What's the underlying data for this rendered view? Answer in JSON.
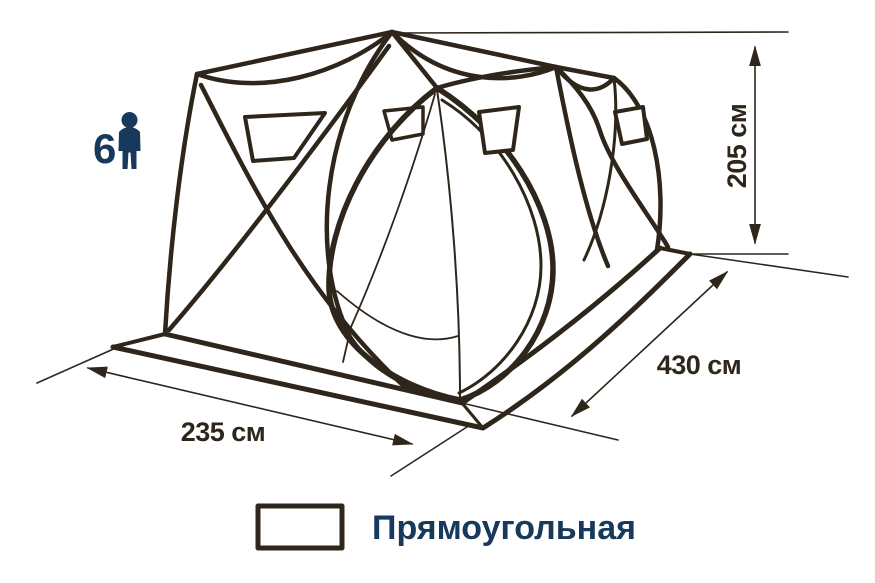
{
  "diagram": {
    "capacity": {
      "count": "6"
    },
    "dimensions": {
      "height_label": "205 см",
      "length_label": "430 см",
      "width_label": "235 см"
    },
    "legend": {
      "shape_label": "Прямоугольная"
    }
  },
  "colors": {
    "line": "#2e261a",
    "navy": "#17395c",
    "background": "#ffffff"
  }
}
